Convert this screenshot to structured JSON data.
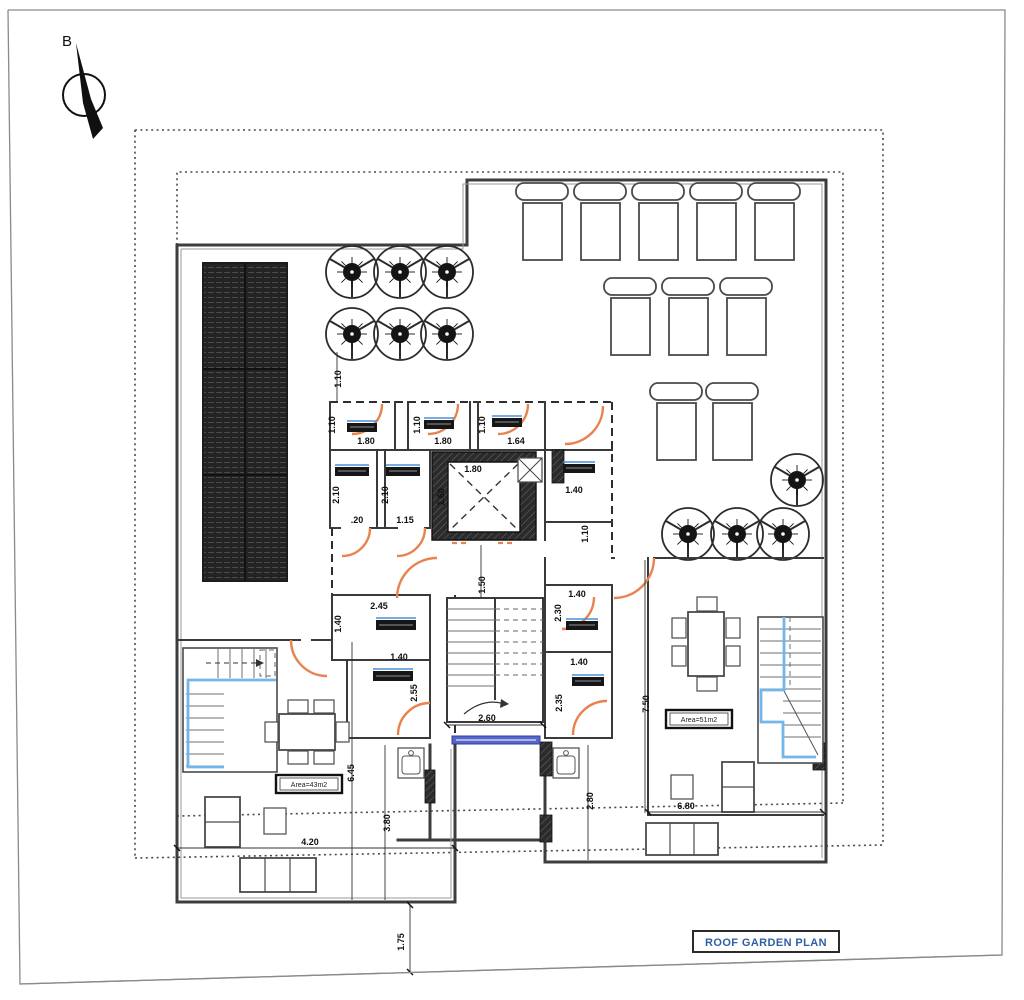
{
  "plan": {
    "title": "ROOF GARDEN PLAN",
    "north_label": "B",
    "area_left": "Area=43m2",
    "area_right": "Area=51m2"
  },
  "room_tags": {
    "legible": false,
    "count": 10
  },
  "colors": {
    "door_arc": "#E8824E",
    "stair_accent": "#74B6EA",
    "window": "#5566CB",
    "tag_topline": "#4A90D9",
    "title_text": "#2F5FA3",
    "wall": "#3D3D3D"
  },
  "dims": [
    {
      "text": "1.10"
    },
    {
      "text": "1.10"
    },
    {
      "text": "1.80"
    },
    {
      "text": "1.10"
    },
    {
      "text": "1.80"
    },
    {
      "text": "1.10"
    },
    {
      "text": "1.64"
    },
    {
      "text": "1.80"
    },
    {
      "text": "1.60"
    },
    {
      "text": "2.10"
    },
    {
      "text": "2.10"
    },
    {
      "text": ".20"
    },
    {
      "text": "1.15"
    },
    {
      "text": "1.40"
    },
    {
      "text": "1.10"
    },
    {
      "text": "1.40"
    },
    {
      "text": "2.30"
    },
    {
      "text": "1.40"
    },
    {
      "text": "2.35"
    },
    {
      "text": "2.45"
    },
    {
      "text": "1.40"
    },
    {
      "text": "1.40"
    },
    {
      "text": "2.55"
    },
    {
      "text": "1.50"
    },
    {
      "text": "2.60"
    },
    {
      "text": "6.45"
    },
    {
      "text": "4.20"
    },
    {
      "text": "3.80"
    },
    {
      "text": "2.80"
    },
    {
      "text": "6.80"
    },
    {
      "text": "7.50"
    },
    {
      "text": "1.75"
    }
  ]
}
